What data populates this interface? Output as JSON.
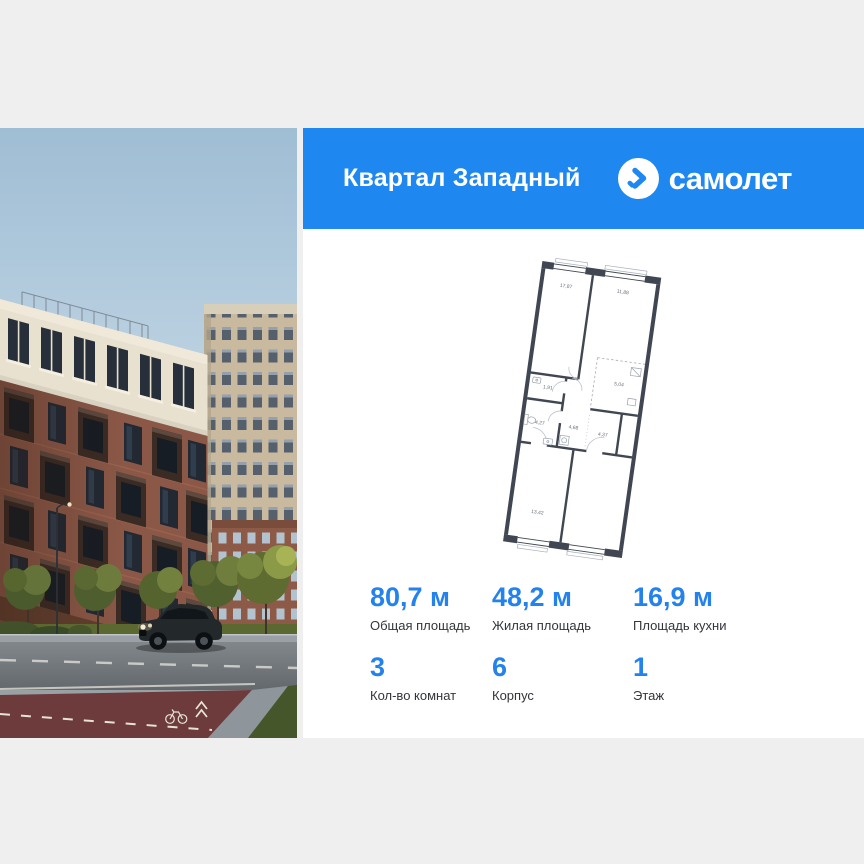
{
  "page": {
    "background_color": "#efefef"
  },
  "header": {
    "background_color": "#1f87f0",
    "title": "Квартал Западный",
    "brand": {
      "icon": "samolet-logo-icon",
      "name": "самолет"
    }
  },
  "photo": {
    "icon": "residential-complex-photo"
  },
  "floor_plan": {
    "wall_color": "#414653",
    "room_areas": [
      "17,87",
      "11,88",
      "5,04",
      "1,91",
      "4,27",
      "4,68",
      "4,37",
      "13,42"
    ]
  },
  "stats": {
    "value_color": "#2482ec",
    "primary": [
      {
        "value": "80,7 м",
        "label": "Общая площадь"
      },
      {
        "value": "48,2 м",
        "label": "Жилая площадь"
      },
      {
        "value": "16,9 м",
        "label": "Площадь кухни"
      }
    ],
    "secondary": [
      {
        "value": "3",
        "label": "Кол-во комнат"
      },
      {
        "value": "6",
        "label": "Корпус"
      },
      {
        "value": "1",
        "label": "Этаж"
      }
    ]
  }
}
